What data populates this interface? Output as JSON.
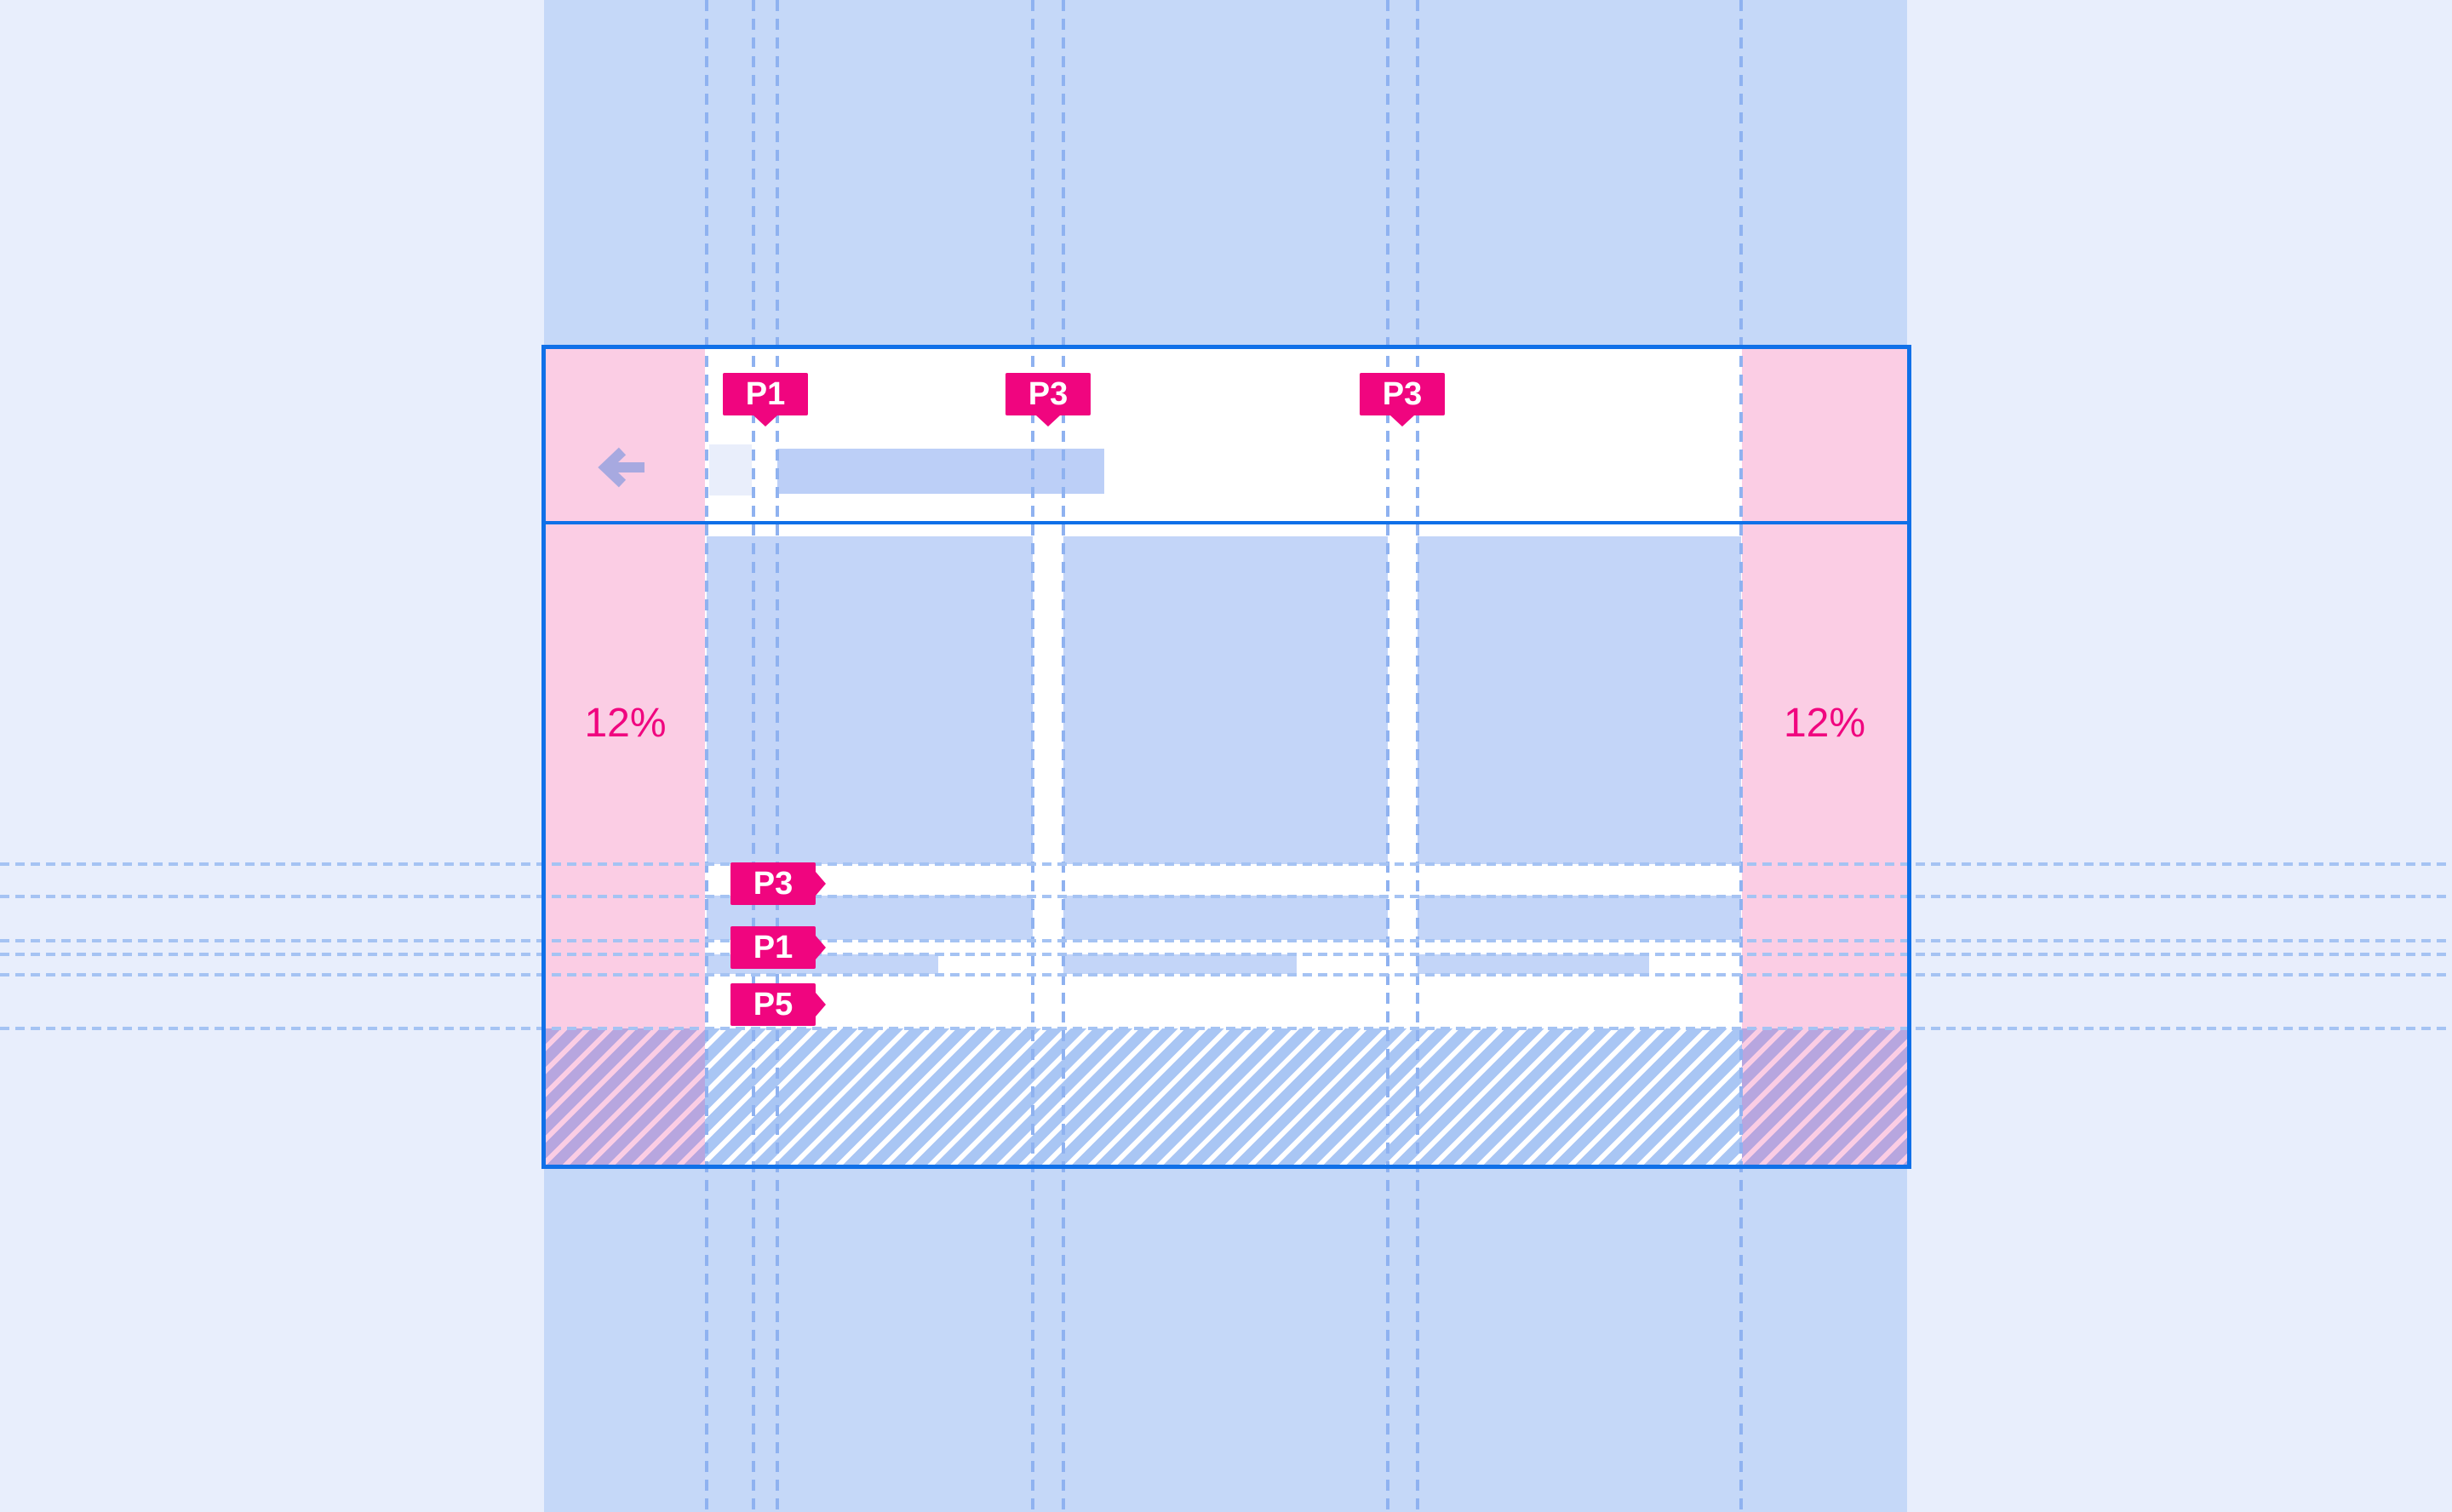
{
  "diagram": {
    "title": "responsive-layout-margins-spec",
    "margins": {
      "left_label": "12%",
      "right_label": "12%"
    },
    "chips_top": [
      {
        "label": "P1"
      },
      {
        "label": "P3"
      },
      {
        "label": "P3"
      }
    ],
    "chips_side": [
      {
        "label": "P3"
      },
      {
        "label": "P1"
      },
      {
        "label": "P5"
      }
    ],
    "icons": [
      {
        "name": "back-arrow-icon",
        "glyph": "←"
      }
    ],
    "colors": {
      "page_background": "#E8EEFC",
      "center_band": "#C5D8F8",
      "card_frame": "#1070E8",
      "margin_pink": "#FBCDE4",
      "placeholder_blue": "#C3D5F8",
      "title_bar_blue": "#BCCFF7",
      "nav_square_lavender": "#E9EEFB",
      "keyline_dash_blue": "#8FB2F0",
      "accent_magenta": "#F0057F",
      "hatch_stripe_blue": "#A9C6F4",
      "hatch_stripe_purple": "#B7A6DF",
      "arrow_periwinkle": "#A7A9E0"
    }
  }
}
